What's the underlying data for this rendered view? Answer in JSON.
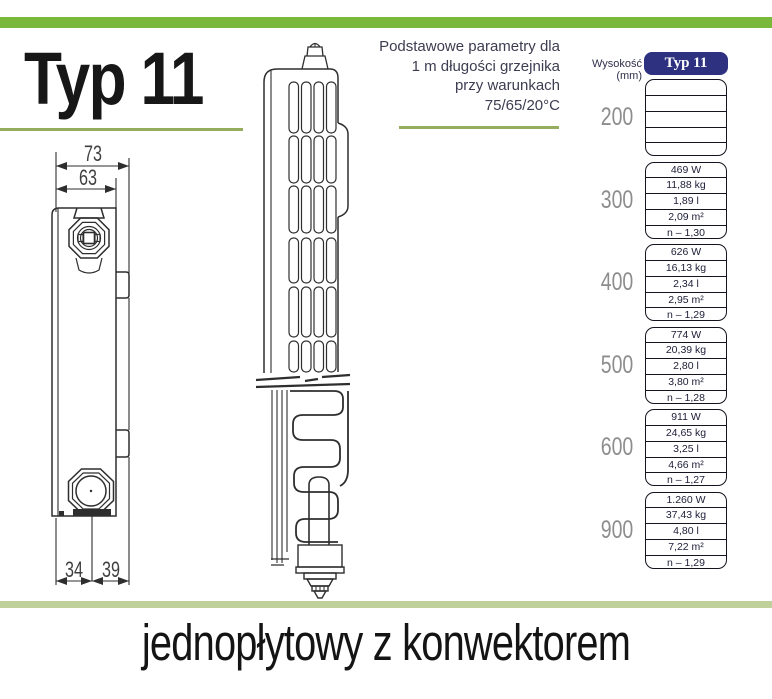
{
  "title": "Typ 11",
  "intro": {
    "line1": "Podstawowe parametry dla",
    "line2": "1 m długości grzejnika",
    "line3": "przy warunkach",
    "line4": "75/65/20°C"
  },
  "table": {
    "height_label": "Wysokość (mm)",
    "column_header": "Typ 11",
    "rows": [
      {
        "height": "200",
        "values": [
          "",
          "",
          "",
          "",
          ""
        ]
      },
      {
        "height": "300",
        "values": [
          "469 W",
          "11,88 kg",
          "1,89 l",
          "2,09 m²",
          "n – 1,30"
        ]
      },
      {
        "height": "400",
        "values": [
          "626 W",
          "16,13 kg",
          "2,34 l",
          "2,95 m²",
          "n – 1,29"
        ]
      },
      {
        "height": "500",
        "values": [
          "774 W",
          "20,39 kg",
          "2,80 l",
          "3,80 m²",
          "n – 1,28"
        ]
      },
      {
        "height": "600",
        "values": [
          "911 W",
          "24,65 kg",
          "3,25 l",
          "4,66 m²",
          "n – 1,27"
        ]
      },
      {
        "height": "900",
        "values": [
          "1.260 W",
          "37,43 kg",
          "4,80 l",
          "7,22 m²",
          "n – 1,29"
        ]
      }
    ]
  },
  "dimensions": {
    "top_outer": "73",
    "top_inner": "63",
    "bottom_left": "34",
    "bottom_right": "39"
  },
  "footer": "jednopłytowy z konwektorem",
  "colors": {
    "accent_green": "#7ab83c",
    "underline_green": "#95ae5e",
    "footer_bar_green": "#c0d09b",
    "header_navy": "#2d3180"
  }
}
